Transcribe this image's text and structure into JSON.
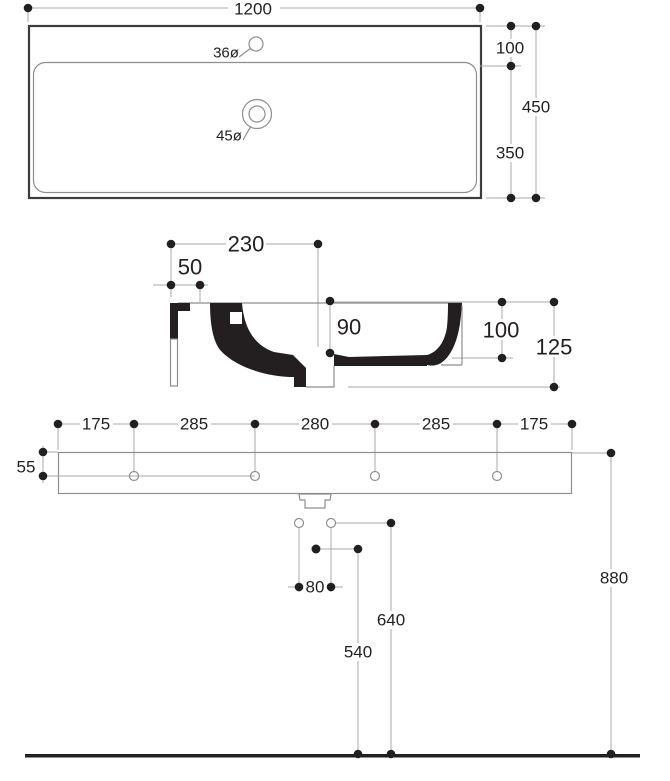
{
  "title": "washbasin technical drawing",
  "colors": {
    "ink": "#231f20",
    "line": "#a8a8a8",
    "background": "#ffffff"
  },
  "plan_view": {
    "width_dim": "1200",
    "deck_dim": "100",
    "basin_dim": "350",
    "depth_dim": "450",
    "faucet_hole_dim": "36ø",
    "drain_hole_dim": "45ø"
  },
  "section_view": {
    "drain_center_dim": "230",
    "channel_dim": "50",
    "bowl_depth_dim": "90",
    "edge_height_dim": "100",
    "overall_height_dim": "125"
  },
  "front_view": {
    "spacing_dims": [
      "175",
      "285",
      "280",
      "285",
      "175"
    ],
    "slab_thickness_dim": "55",
    "hole_spacing_dim": "80",
    "drain_center_height_dim": "540",
    "supply_height_dim": "640",
    "rim_height_dim": "880"
  }
}
